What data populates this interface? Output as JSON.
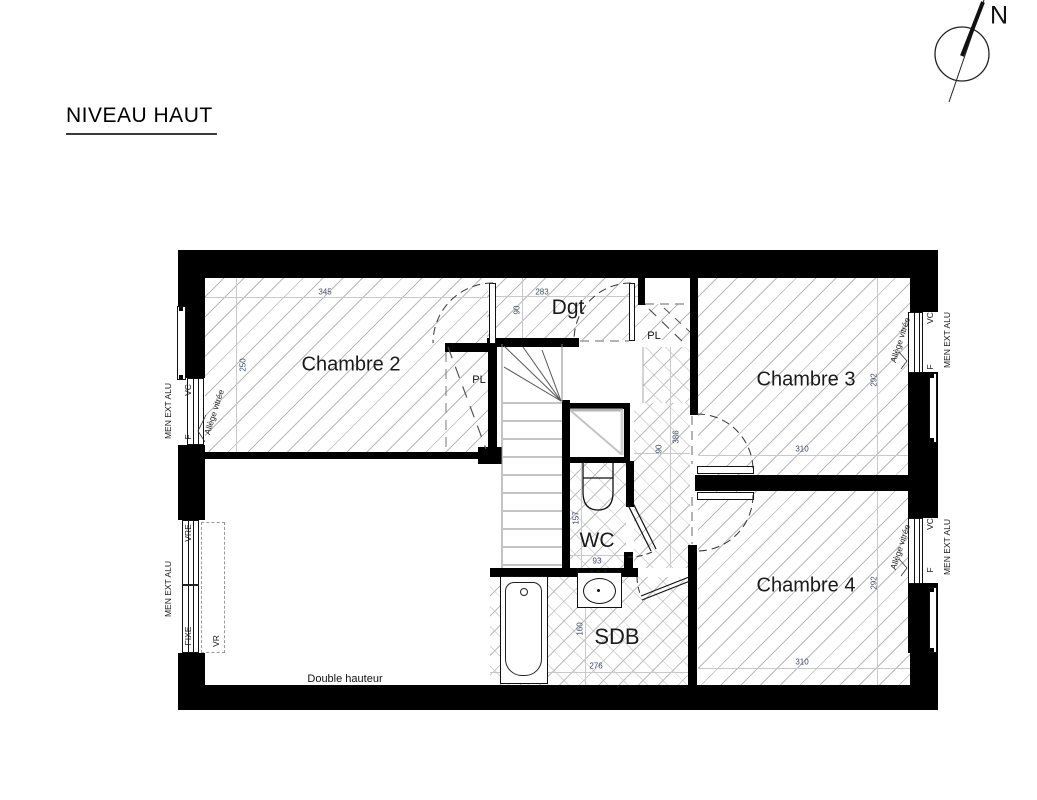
{
  "title": "NIVEAU HAUT",
  "compass": {
    "north_label": "N"
  },
  "rooms": {
    "chambre2": {
      "name": "Chambre 2",
      "dim_w": "345",
      "dim_h": "250"
    },
    "dgt": {
      "name": "Dgt",
      "dim_w": "283",
      "dim_h": "90"
    },
    "chambre3": {
      "name": "Chambre 3",
      "dim_w": "310",
      "dim_h": "292"
    },
    "chambre4": {
      "name": "Chambre 4",
      "dim_w": "310",
      "dim_h": "292"
    },
    "wc": {
      "name": "WC",
      "dim_w": "93",
      "dim_h": "157"
    },
    "sdb": {
      "name": "SDB",
      "dim_w": "276",
      "dim_h": "160"
    },
    "hallway": {
      "dim_w": "90",
      "dim_l": "386"
    },
    "double_height": {
      "label": "Double hauteur"
    }
  },
  "closets": {
    "closet1": "PL",
    "closet2": "PL"
  },
  "windows": {
    "left_top": {
      "menuiserie": "MEN EXT ALU",
      "shutter": "VC",
      "window": "F",
      "sill": "Allège vitrée"
    },
    "left_bottom": {
      "menuiserie": "MEN EXT ALU",
      "top": "VRE",
      "bottom": "FIXE",
      "shutter": "VR"
    },
    "right_top": {
      "menuiserie": "MEN EXT ALU",
      "shutter": "VC",
      "window": "F",
      "sill": "Allège vitrée"
    },
    "right_bottom": {
      "menuiserie": "MEN EXT ALU",
      "shutter": "VC",
      "window": "F",
      "sill": "Allège vitrée"
    }
  },
  "colors": {
    "wall": "#000000",
    "hatch": "#b9b9b9",
    "dim_text": "#3d4a63",
    "dim_line": "#c9c9c9",
    "label_text": "#111111"
  }
}
